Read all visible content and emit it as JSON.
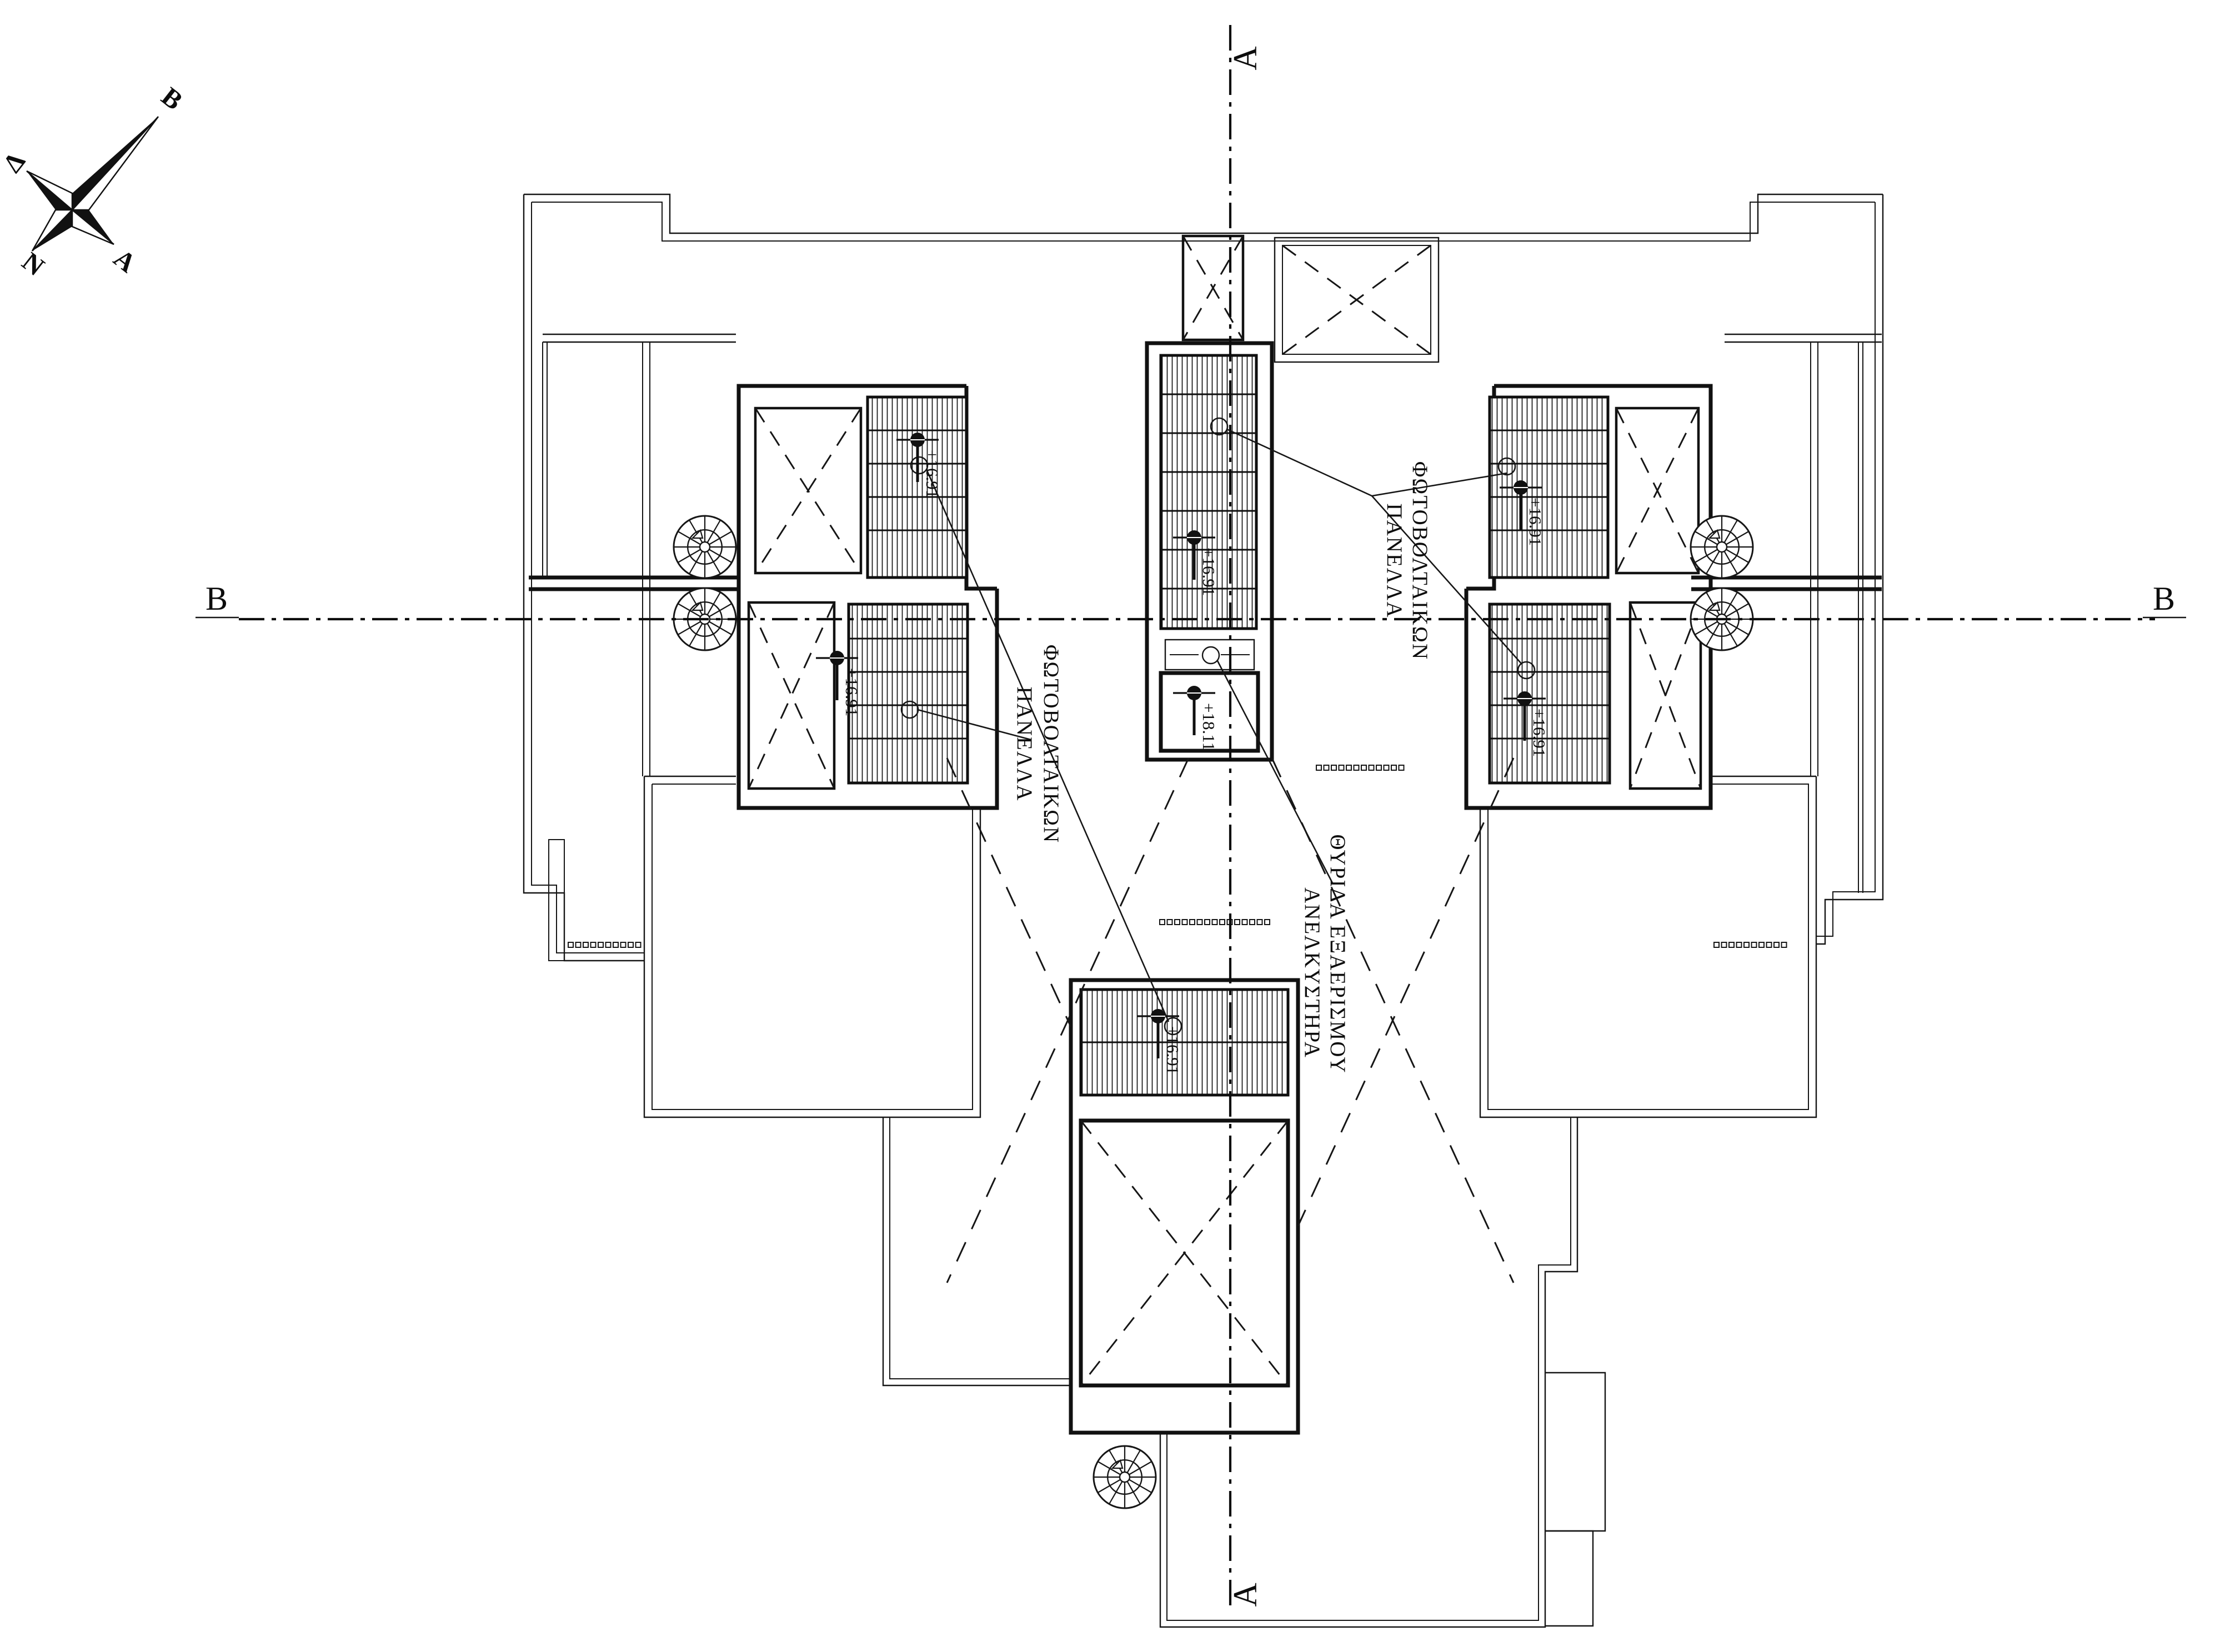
{
  "drawing": {
    "type": "architectural-roof-plan",
    "colors": {
      "ink": "#111111",
      "paper": "#ffffff"
    },
    "compass": {
      "north_label": "Β",
      "west_label": "Δ",
      "south_label": "Ν",
      "east_label": "Α"
    },
    "section_lines": {
      "vertical": {
        "label_top": "A",
        "label_bottom": "A"
      },
      "horizontal": {
        "label_left": "B",
        "label_right": "B"
      }
    },
    "annotations": {
      "pv_label_left": {
        "line1": "ΦΩΤΟΒΟΛΤΑΙΚΩΝ",
        "line2": "ΠΑΝΕΛΛΑ"
      },
      "pv_label_right": {
        "line1": "ΦΩΤΟΒΟΛΤΑΙΚΩΝ",
        "line2": "ΠΑΝΕΛΛΑ"
      },
      "vent_label": {
        "line1": "ΘΥΡΙΔΑ ΕΞΑΕΡΙΣΜΟΥ",
        "line2": "ΑΝΕΛΚΥΣΤΗΡΑ"
      }
    },
    "spot_levels": {
      "left_top": "+16.91",
      "left_bottom": "+16.91",
      "center": "+16.91",
      "right_top": "+16.91",
      "right_bottom": "+16.91",
      "bottom": "+16.91",
      "machine_room": "+18.11"
    },
    "stairs": {
      "step_numbers": "1-17"
    }
  }
}
